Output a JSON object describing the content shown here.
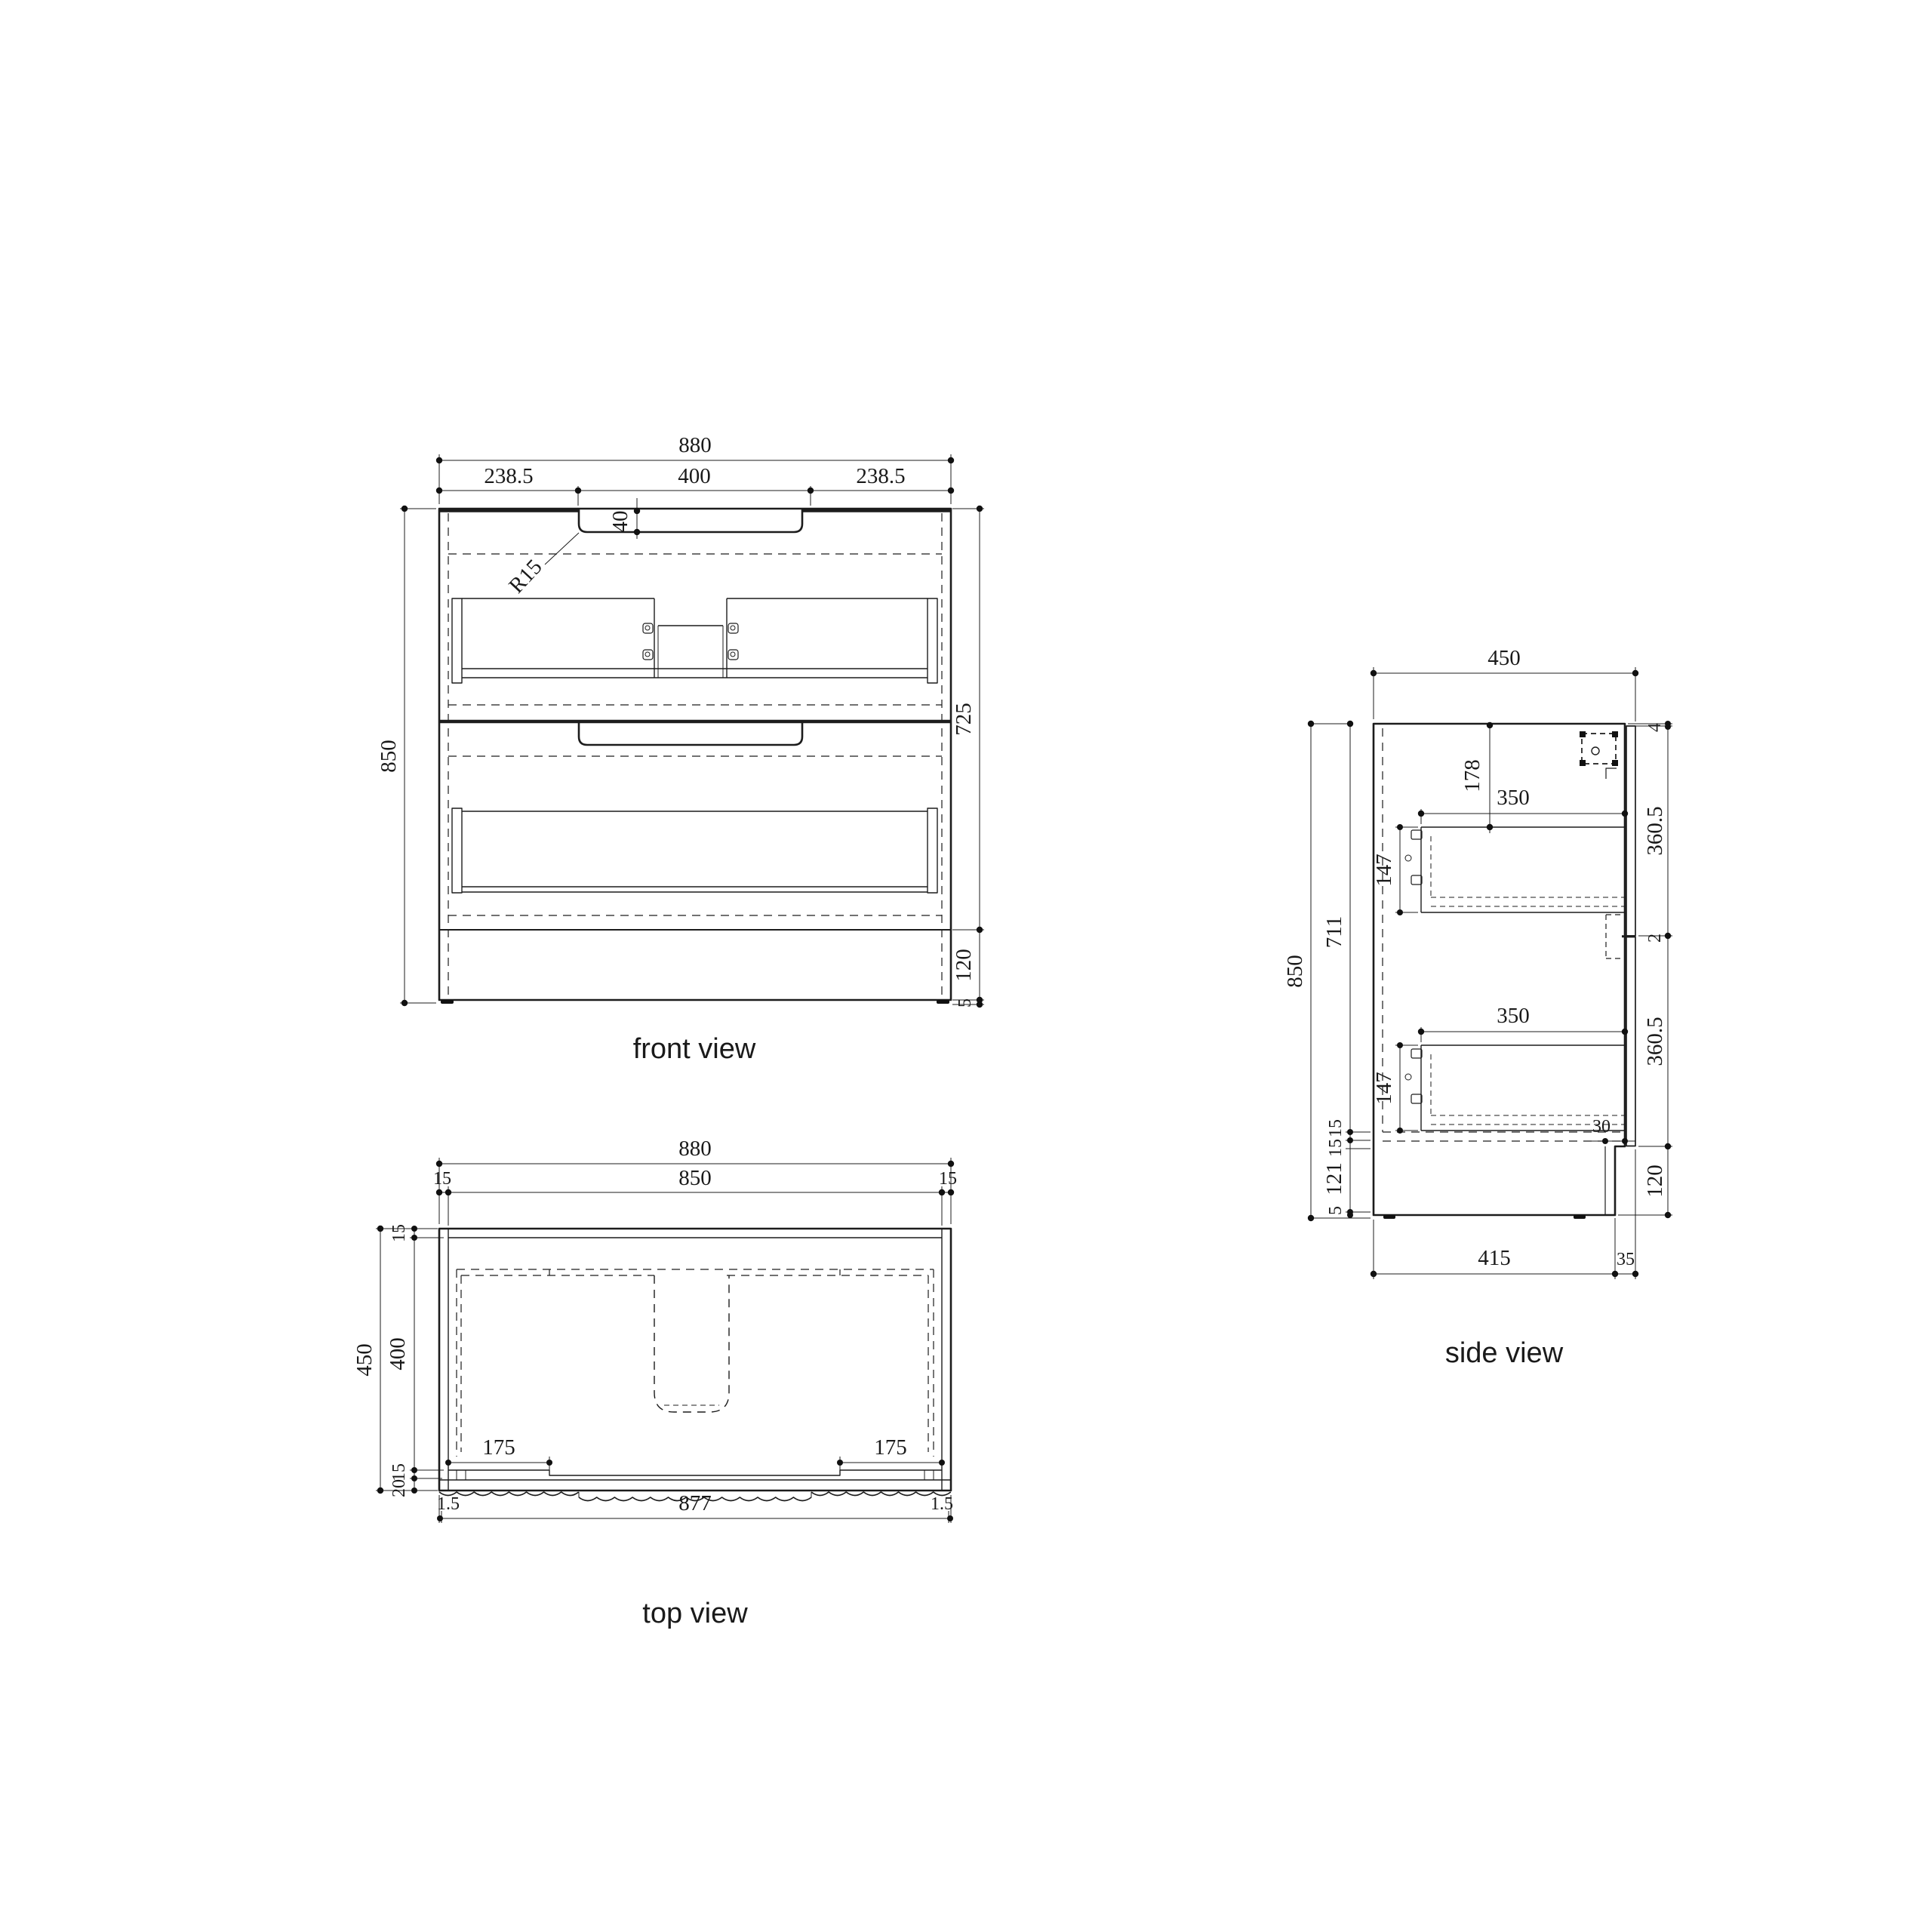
{
  "front_view": {
    "label": "front view",
    "overall_width": "880",
    "shoulder_left": "238.5",
    "handle_width": "400",
    "shoulder_right": "238.5",
    "handle_depth": "40",
    "handle_radius": "R15",
    "overall_height": "850",
    "body_height": "725",
    "plinth_height": "120",
    "foot_height": "5"
  },
  "top_view": {
    "label": "top view",
    "overall_width": "880",
    "panel_span": "850",
    "wall_left": "15",
    "wall_right": "15",
    "overall_depth": "450",
    "wall_back": "15",
    "inner_depth": "400",
    "wall_front": "15",
    "front_band": "20",
    "flat_left": "175",
    "flat_right": "175",
    "edge_left": "1.5",
    "front_panel_width": "877",
    "edge_right": "1.5"
  },
  "side_view": {
    "label": "side view",
    "overall_depth": "450",
    "overall_height": "850",
    "carcass_height": "711",
    "panel_15a": "15",
    "panel_15b": "15",
    "plinth_inner": "121",
    "foot_height": "5",
    "top_gap": "4",
    "front_upper": "360.5",
    "front_gap": "2",
    "front_lower": "360.5",
    "toe_recess": "30",
    "plinth_height": "120",
    "drawer_top_offset": "178",
    "drawer_depth_upper": "350",
    "drawer_height_upper": "147",
    "drawer_depth_lower": "350",
    "drawer_height_lower": "147",
    "base_depth": "415",
    "front_setback": "35"
  }
}
